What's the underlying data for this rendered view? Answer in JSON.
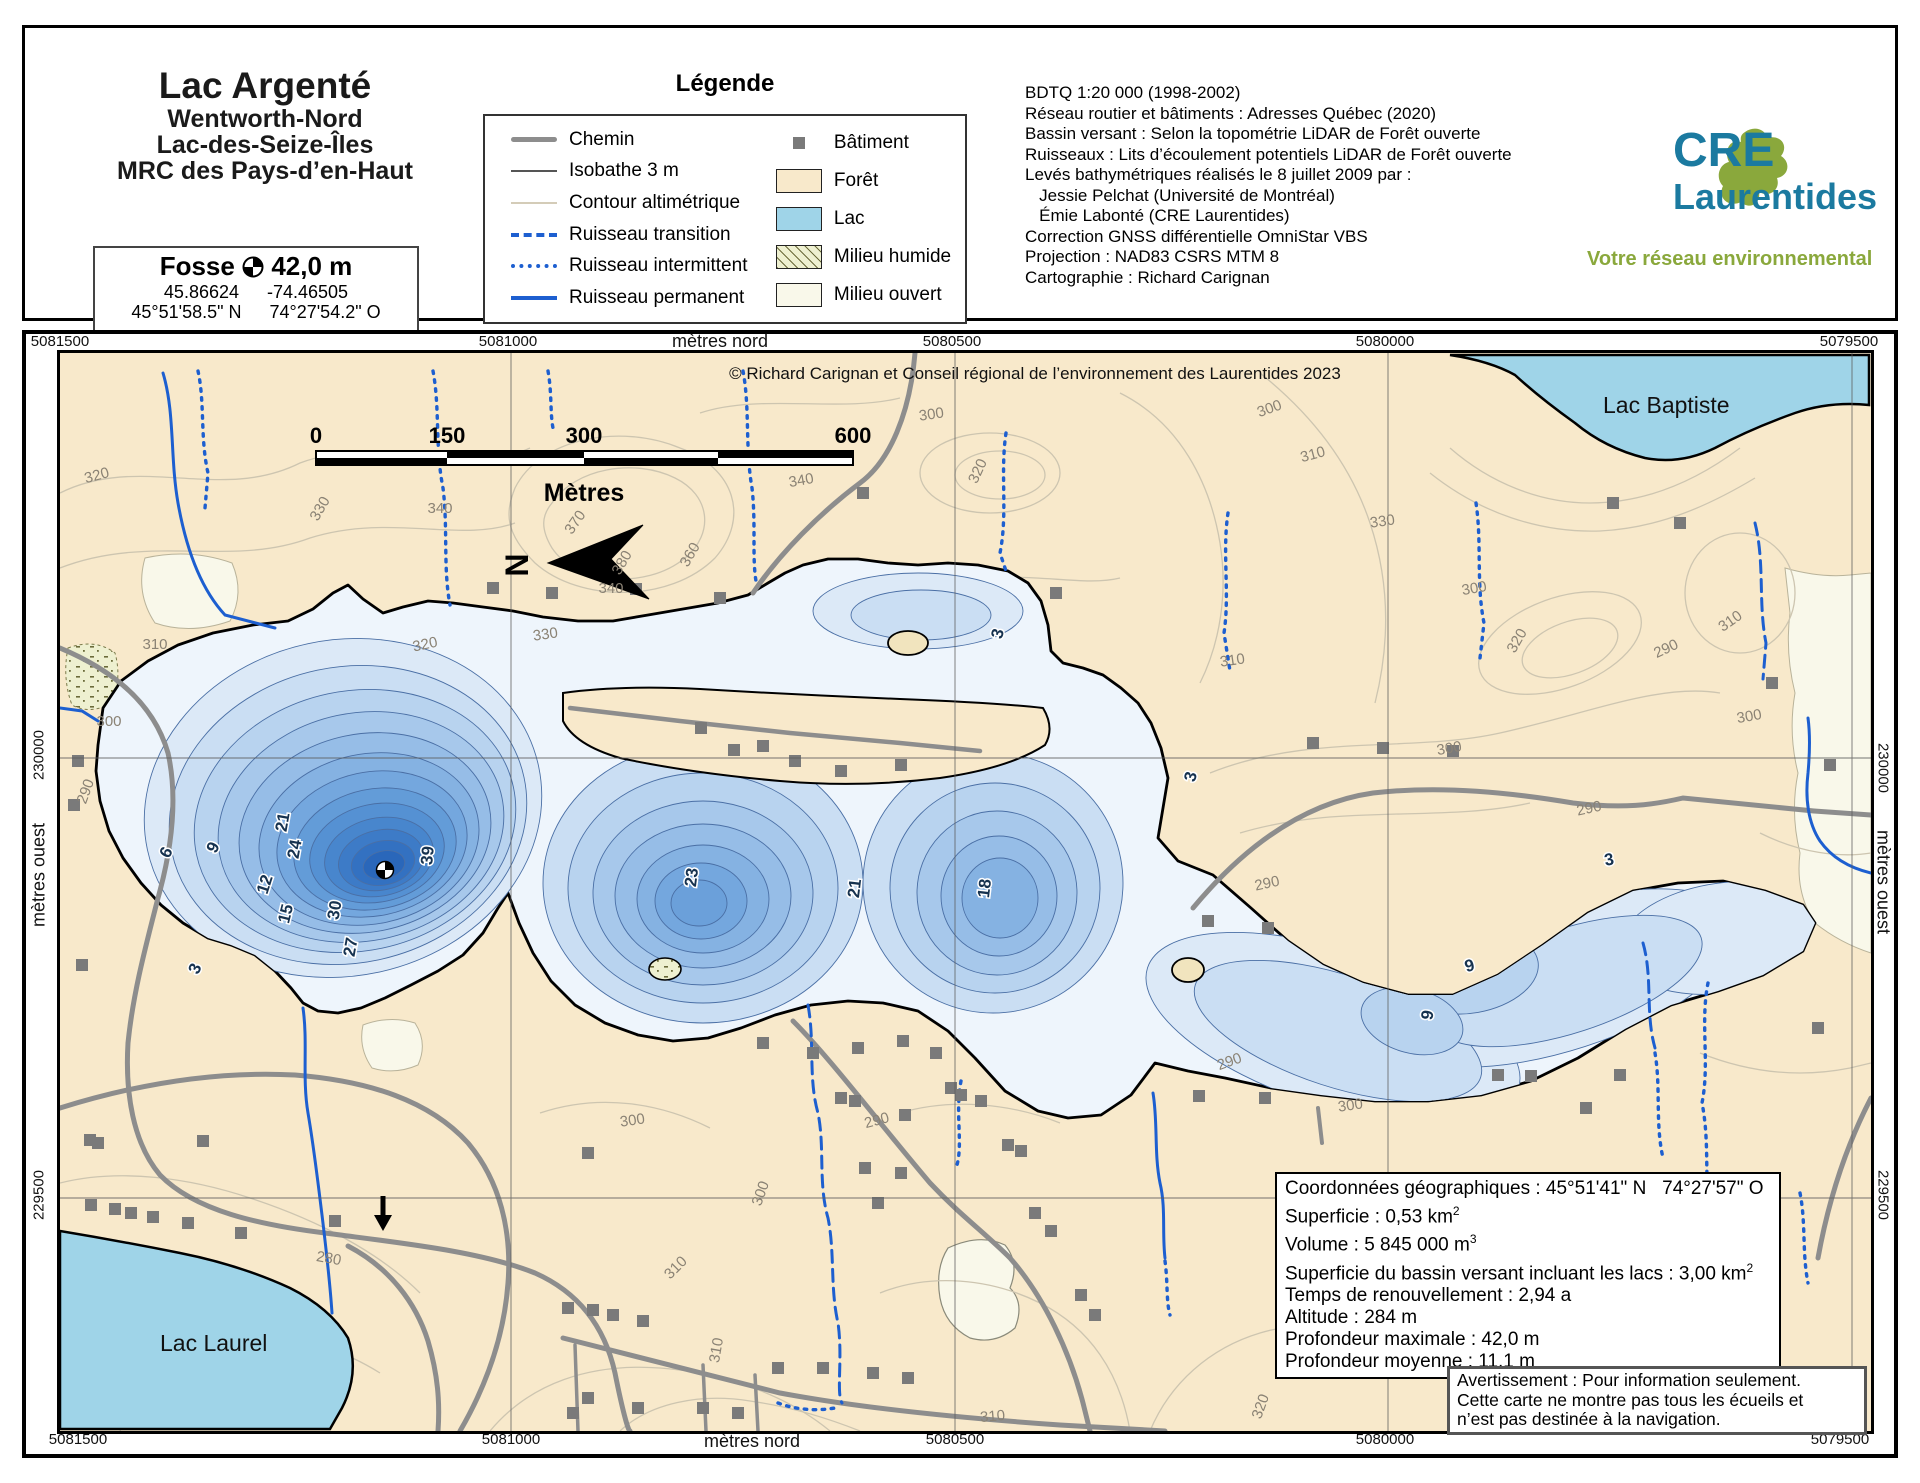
{
  "header": {
    "title": "Lac Argenté",
    "subtitle_lines": [
      "Wentworth-Nord",
      "Lac-des-Seize-Îles",
      "MRC des Pays-d’en-Haut"
    ],
    "fosse": {
      "label": "Fosse",
      "depth": "42,0 m",
      "lat_dec": "45.86624",
      "lon_dec": "-74.46505",
      "lat_dms": "45°51'58.5\" N",
      "lon_dms": "74°27'54.2\" O"
    }
  },
  "legend": {
    "title": "Légende",
    "left": [
      {
        "label": "Chemin",
        "type": "road"
      },
      {
        "label": "Isobathe 3 m",
        "type": "isobath"
      },
      {
        "label": "Contour altimétrique",
        "type": "contour"
      },
      {
        "label": "Ruisseau transition",
        "type": "sdash"
      },
      {
        "label": "Ruisseau intermittent",
        "type": "sdot"
      },
      {
        "label": "Ruisseau permanent",
        "type": "ssolid"
      }
    ],
    "right": [
      {
        "label": "Bâtiment",
        "type": "building"
      },
      {
        "label": "Forêt",
        "type": "forest"
      },
      {
        "label": "Lac",
        "type": "lake"
      },
      {
        "label": "Milieu humide",
        "type": "wetland"
      },
      {
        "label": "Milieu ouvert",
        "type": "open"
      }
    ]
  },
  "sources": {
    "lines": [
      "BDTQ 1:20 000 (1998-2002)",
      "Réseau routier et bâtiments : Adresses Québec (2020)",
      "Bassin versant : Selon la topométrie LiDAR de Forêt ouverte",
      "Ruisseaux : Lits d’écoulement potentiels LiDAR de Forêt ouverte",
      "Levés bathymétriques réalisés le 8 juillet 2009 par :",
      "   Jessie Pelchat (Université de Montréal)",
      "   Émie Labonté (CRE Laurentides)",
      "Correction GNSS différentielle OmniStar VBS",
      "Projection : NAD83 CSRS MTM 8",
      "Cartographie : Richard Carignan"
    ]
  },
  "logo": {
    "acronym": "CRE",
    "name": "Laurentides",
    "tagline": "Votre réseau environnemental"
  },
  "map": {
    "copyright": "© Richard Carignan et Conseil régional de l’environnement des Laurentides 2023",
    "axis": {
      "unit_top": "mètres nord",
      "unit_bottom": "mètres nord",
      "unit_left": "mètres ouest",
      "unit_right": "mètres ouest",
      "top": [
        {
          "v": "5081500",
          "x": 60
        },
        {
          "v": "5081000",
          "x": 508
        },
        {
          "v": "5080500",
          "x": 952
        },
        {
          "v": "5080000",
          "x": 1385
        },
        {
          "v": "5079500",
          "x": 1849
        }
      ],
      "unit_top_x": 720,
      "bottom": [
        {
          "v": "5081500",
          "x": 78
        },
        {
          "v": "5081000",
          "x": 511
        },
        {
          "v": "5080500",
          "x": 955
        },
        {
          "v": "5080000",
          "x": 1385
        },
        {
          "v": "5079500",
          "x": 1840
        }
      ],
      "unit_bottom_x": 752,
      "left": [
        {
          "v": "230000",
          "y": 755
        },
        {
          "v": "229500",
          "y": 1195
        }
      ],
      "unit_left_y": 875,
      "right": [
        {
          "v": "230000",
          "y": 768
        },
        {
          "v": "229500",
          "y": 1195
        }
      ],
      "unit_right_y": 882
    },
    "scalebar": {
      "ticks": [
        {
          "t": "0",
          "x": 256
        },
        {
          "t": "150",
          "x": 387
        },
        {
          "t": "300",
          "x": 524
        },
        {
          "t": "600",
          "x": 793
        }
      ],
      "unit": "Mètres"
    },
    "north_letter": "N",
    "place_labels": [
      {
        "t": "Lac Baptiste",
        "x": 1543,
        "y": 60
      },
      {
        "t": "Lac Laurel",
        "x": 100,
        "y": 998
      }
    ],
    "depth_labels": [
      {
        "t": "6",
        "x": 111,
        "y": 502,
        "r": -62
      },
      {
        "t": "9",
        "x": 158,
        "y": 497,
        "r": -62
      },
      {
        "t": "21",
        "x": 228,
        "y": 470,
        "r": -80
      },
      {
        "t": "24",
        "x": 240,
        "y": 497,
        "r": -80
      },
      {
        "t": "12",
        "x": 210,
        "y": 533,
        "r": -72
      },
      {
        "t": "15",
        "x": 231,
        "y": 562,
        "r": -76
      },
      {
        "t": "30",
        "x": 280,
        "y": 558,
        "r": -80
      },
      {
        "t": "27",
        "x": 296,
        "y": 595,
        "r": -80
      },
      {
        "t": "39",
        "x": 373,
        "y": 503,
        "r": -85
      },
      {
        "t": "3",
        "x": 140,
        "y": 618,
        "r": -65
      },
      {
        "t": "23",
        "x": 637,
        "y": 525,
        "r": -83
      },
      {
        "t": "21",
        "x": 800,
        "y": 536,
        "r": -83
      },
      {
        "t": "18",
        "x": 930,
        "y": 536,
        "r": -83
      },
      {
        "t": "3",
        "x": 943,
        "y": 282,
        "r": -75
      },
      {
        "t": "3",
        "x": 1136,
        "y": 425,
        "r": -75
      },
      {
        "t": "9",
        "x": 1411,
        "y": 618,
        "r": -15
      },
      {
        "t": "9",
        "x": 1373,
        "y": 663,
        "r": -80
      },
      {
        "t": "3",
        "x": 1550,
        "y": 512,
        "r": -10
      }
    ],
    "contour_labels": [
      {
        "t": "320",
        "x": 38,
        "y": 127,
        "r": -15
      },
      {
        "t": "310",
        "x": 95,
        "y": 296,
        "r": 0
      },
      {
        "t": "300",
        "x": 49,
        "y": 373,
        "r": 0
      },
      {
        "t": "330",
        "x": 264,
        "y": 158,
        "r": -60
      },
      {
        "t": "340",
        "x": 380,
        "y": 160,
        "r": 0
      },
      {
        "t": "370",
        "x": 519,
        "y": 172,
        "r": -55
      },
      {
        "t": "380",
        "x": 566,
        "y": 212,
        "r": -60
      },
      {
        "t": "360",
        "x": 634,
        "y": 204,
        "r": -60
      },
      {
        "t": "340",
        "x": 551,
        "y": 240,
        "r": 0
      },
      {
        "t": "330",
        "x": 486,
        "y": 286,
        "r": -8
      },
      {
        "t": "320",
        "x": 366,
        "y": 296,
        "r": -12
      },
      {
        "t": "340",
        "x": 742,
        "y": 132,
        "r": -10
      },
      {
        "t": "320",
        "x": 922,
        "y": 120,
        "r": -65
      },
      {
        "t": "300",
        "x": 872,
        "y": 66,
        "r": -8
      },
      {
        "t": "310",
        "x": 1173,
        "y": 312,
        "r": -8
      },
      {
        "t": "300",
        "x": 1211,
        "y": 60,
        "r": -20
      },
      {
        "t": "310",
        "x": 1254,
        "y": 106,
        "r": -15
      },
      {
        "t": "330",
        "x": 1323,
        "y": 173,
        "r": -8
      },
      {
        "t": "300",
        "x": 1415,
        "y": 240,
        "r": -10
      },
      {
        "t": "320",
        "x": 1461,
        "y": 290,
        "r": -60
      },
      {
        "t": "290",
        "x": 1608,
        "y": 300,
        "r": -25
      },
      {
        "t": "300",
        "x": 1390,
        "y": 400,
        "r": -10
      },
      {
        "t": "290",
        "x": 1530,
        "y": 460,
        "r": -12
      },
      {
        "t": "290",
        "x": 1208,
        "y": 535,
        "r": -12
      },
      {
        "t": "290",
        "x": 1171,
        "y": 713,
        "r": -20
      },
      {
        "t": "300",
        "x": 1291,
        "y": 757,
        "r": -8
      },
      {
        "t": "280",
        "x": 268,
        "y": 910,
        "r": 10
      },
      {
        "t": "300",
        "x": 573,
        "y": 772,
        "r": -8
      },
      {
        "t": "290",
        "x": 818,
        "y": 772,
        "r": -15
      },
      {
        "t": "300",
        "x": 705,
        "y": 842,
        "r": -70
      },
      {
        "t": "310",
        "x": 619,
        "y": 918,
        "r": -45
      },
      {
        "t": "310",
        "x": 661,
        "y": 998,
        "r": -80
      },
      {
        "t": "310",
        "x": 933,
        "y": 1068,
        "r": -5
      },
      {
        "t": "320",
        "x": 1205,
        "y": 1055,
        "r": -70
      },
      {
        "t": "290",
        "x": 30,
        "y": 440,
        "r": -70
      },
      {
        "t": "300",
        "x": 1690,
        "y": 368,
        "r": -10
      },
      {
        "t": "310",
        "x": 1673,
        "y": 272,
        "r": -35
      }
    ],
    "buildings": [
      [
        433,
        235
      ],
      [
        492,
        240
      ],
      [
        576,
        236
      ],
      [
        660,
        245
      ],
      [
        803,
        140
      ],
      [
        996,
        240
      ],
      [
        641,
        375
      ],
      [
        674,
        397
      ],
      [
        703,
        393
      ],
      [
        735,
        408
      ],
      [
        781,
        418
      ],
      [
        841,
        412
      ],
      [
        18,
        408
      ],
      [
        14,
        452
      ],
      [
        22,
        612
      ],
      [
        30,
        787
      ],
      [
        703,
        690
      ],
      [
        753,
        700
      ],
      [
        798,
        695
      ],
      [
        843,
        688
      ],
      [
        876,
        700
      ],
      [
        781,
        745
      ],
      [
        795,
        748
      ],
      [
        845,
        762
      ],
      [
        805,
        815
      ],
      [
        841,
        820
      ],
      [
        818,
        850
      ],
      [
        891,
        735
      ],
      [
        901,
        742
      ],
      [
        921,
        748
      ],
      [
        948,
        792
      ],
      [
        961,
        798
      ],
      [
        975,
        860
      ],
      [
        991,
        878
      ],
      [
        1021,
        942
      ],
      [
        1035,
        962
      ],
      [
        528,
        800
      ],
      [
        508,
        955
      ],
      [
        533,
        957
      ],
      [
        553,
        962
      ],
      [
        583,
        968
      ],
      [
        513,
        1060
      ],
      [
        528,
        1045
      ],
      [
        578,
        1055
      ],
      [
        643,
        1055
      ],
      [
        678,
        1060
      ],
      [
        718,
        1015
      ],
      [
        763,
        1015
      ],
      [
        813,
        1020
      ],
      [
        848,
        1025
      ],
      [
        31,
        852
      ],
      [
        55,
        856
      ],
      [
        71,
        860
      ],
      [
        93,
        864
      ],
      [
        128,
        870
      ],
      [
        181,
        880
      ],
      [
        275,
        868
      ],
      [
        38,
        790
      ],
      [
        143,
        788
      ],
      [
        1148,
        568
      ],
      [
        1208,
        575
      ],
      [
        1253,
        390
      ],
      [
        1323,
        395
      ],
      [
        1393,
        398
      ],
      [
        1553,
        150
      ],
      [
        1620,
        170
      ],
      [
        1139,
        743
      ],
      [
        1205,
        745
      ],
      [
        1438,
        722
      ],
      [
        1471,
        723
      ],
      [
        1560,
        722
      ],
      [
        1526,
        755
      ],
      [
        1758,
        675
      ],
      [
        1712,
        330
      ],
      [
        1770,
        412
      ]
    ],
    "info_box": {
      "lines": [
        {
          "t": "Coordonnées géographiques : 45°51'41\" N   74°27'57\" O",
          "sup": ""
        },
        {
          "t": "Superficie : 0,53 km",
          "sup": "2"
        },
        {
          "t": "Volume : 5 845 000 m",
          "sup": "3"
        },
        {
          "t": "Superficie du bassin versant incluant les lacs : 3,00 km",
          "sup": "2"
        },
        {
          "t": "Temps de renouvellement : 2,94 a",
          "sup": ""
        },
        {
          "t": "Altitude : 284 m",
          "sup": ""
        },
        {
          "t": "Profondeur maximale : 42,0 m",
          "sup": ""
        },
        {
          "t": "Profondeur moyenne : 11,1 m",
          "sup": ""
        }
      ]
    },
    "warning": {
      "lines": [
        "Avertissement : Pour information seulement.",
        "Cette carte ne montre pas tous les écueils et",
        "n’est pas destinée à la navigation."
      ]
    },
    "fosse_marker": {
      "x": 325,
      "y": 517
    }
  },
  "colors": {
    "forest": "#f8e9cb",
    "lake": "#9fd4e8",
    "water_base": "#eef5fc",
    "road": "#8d8d8d",
    "building": "#7a7a7a",
    "stream": "#1d5fd0",
    "contour_line": "#cdc5b0",
    "wetland": "#eef0d0",
    "open": "#f9f8ea",
    "logo_teal": "#1b7aa0",
    "logo_green": "#8aa83c",
    "depth_palette": {
      "3": "#dce9f7",
      "6": "#cadef3",
      "9": "#b8d3ef",
      "12": "#a7c8eb",
      "15": "#96bde7",
      "18": "#85b2e2",
      "21": "#74a7de",
      "23": "#6ba0da",
      "24": "#639cd8",
      "27": "#5591d3",
      "30": "#4886cd",
      "33": "#3d7bc7",
      "36": "#3371c1",
      "39": "#2a67ba"
    }
  }
}
